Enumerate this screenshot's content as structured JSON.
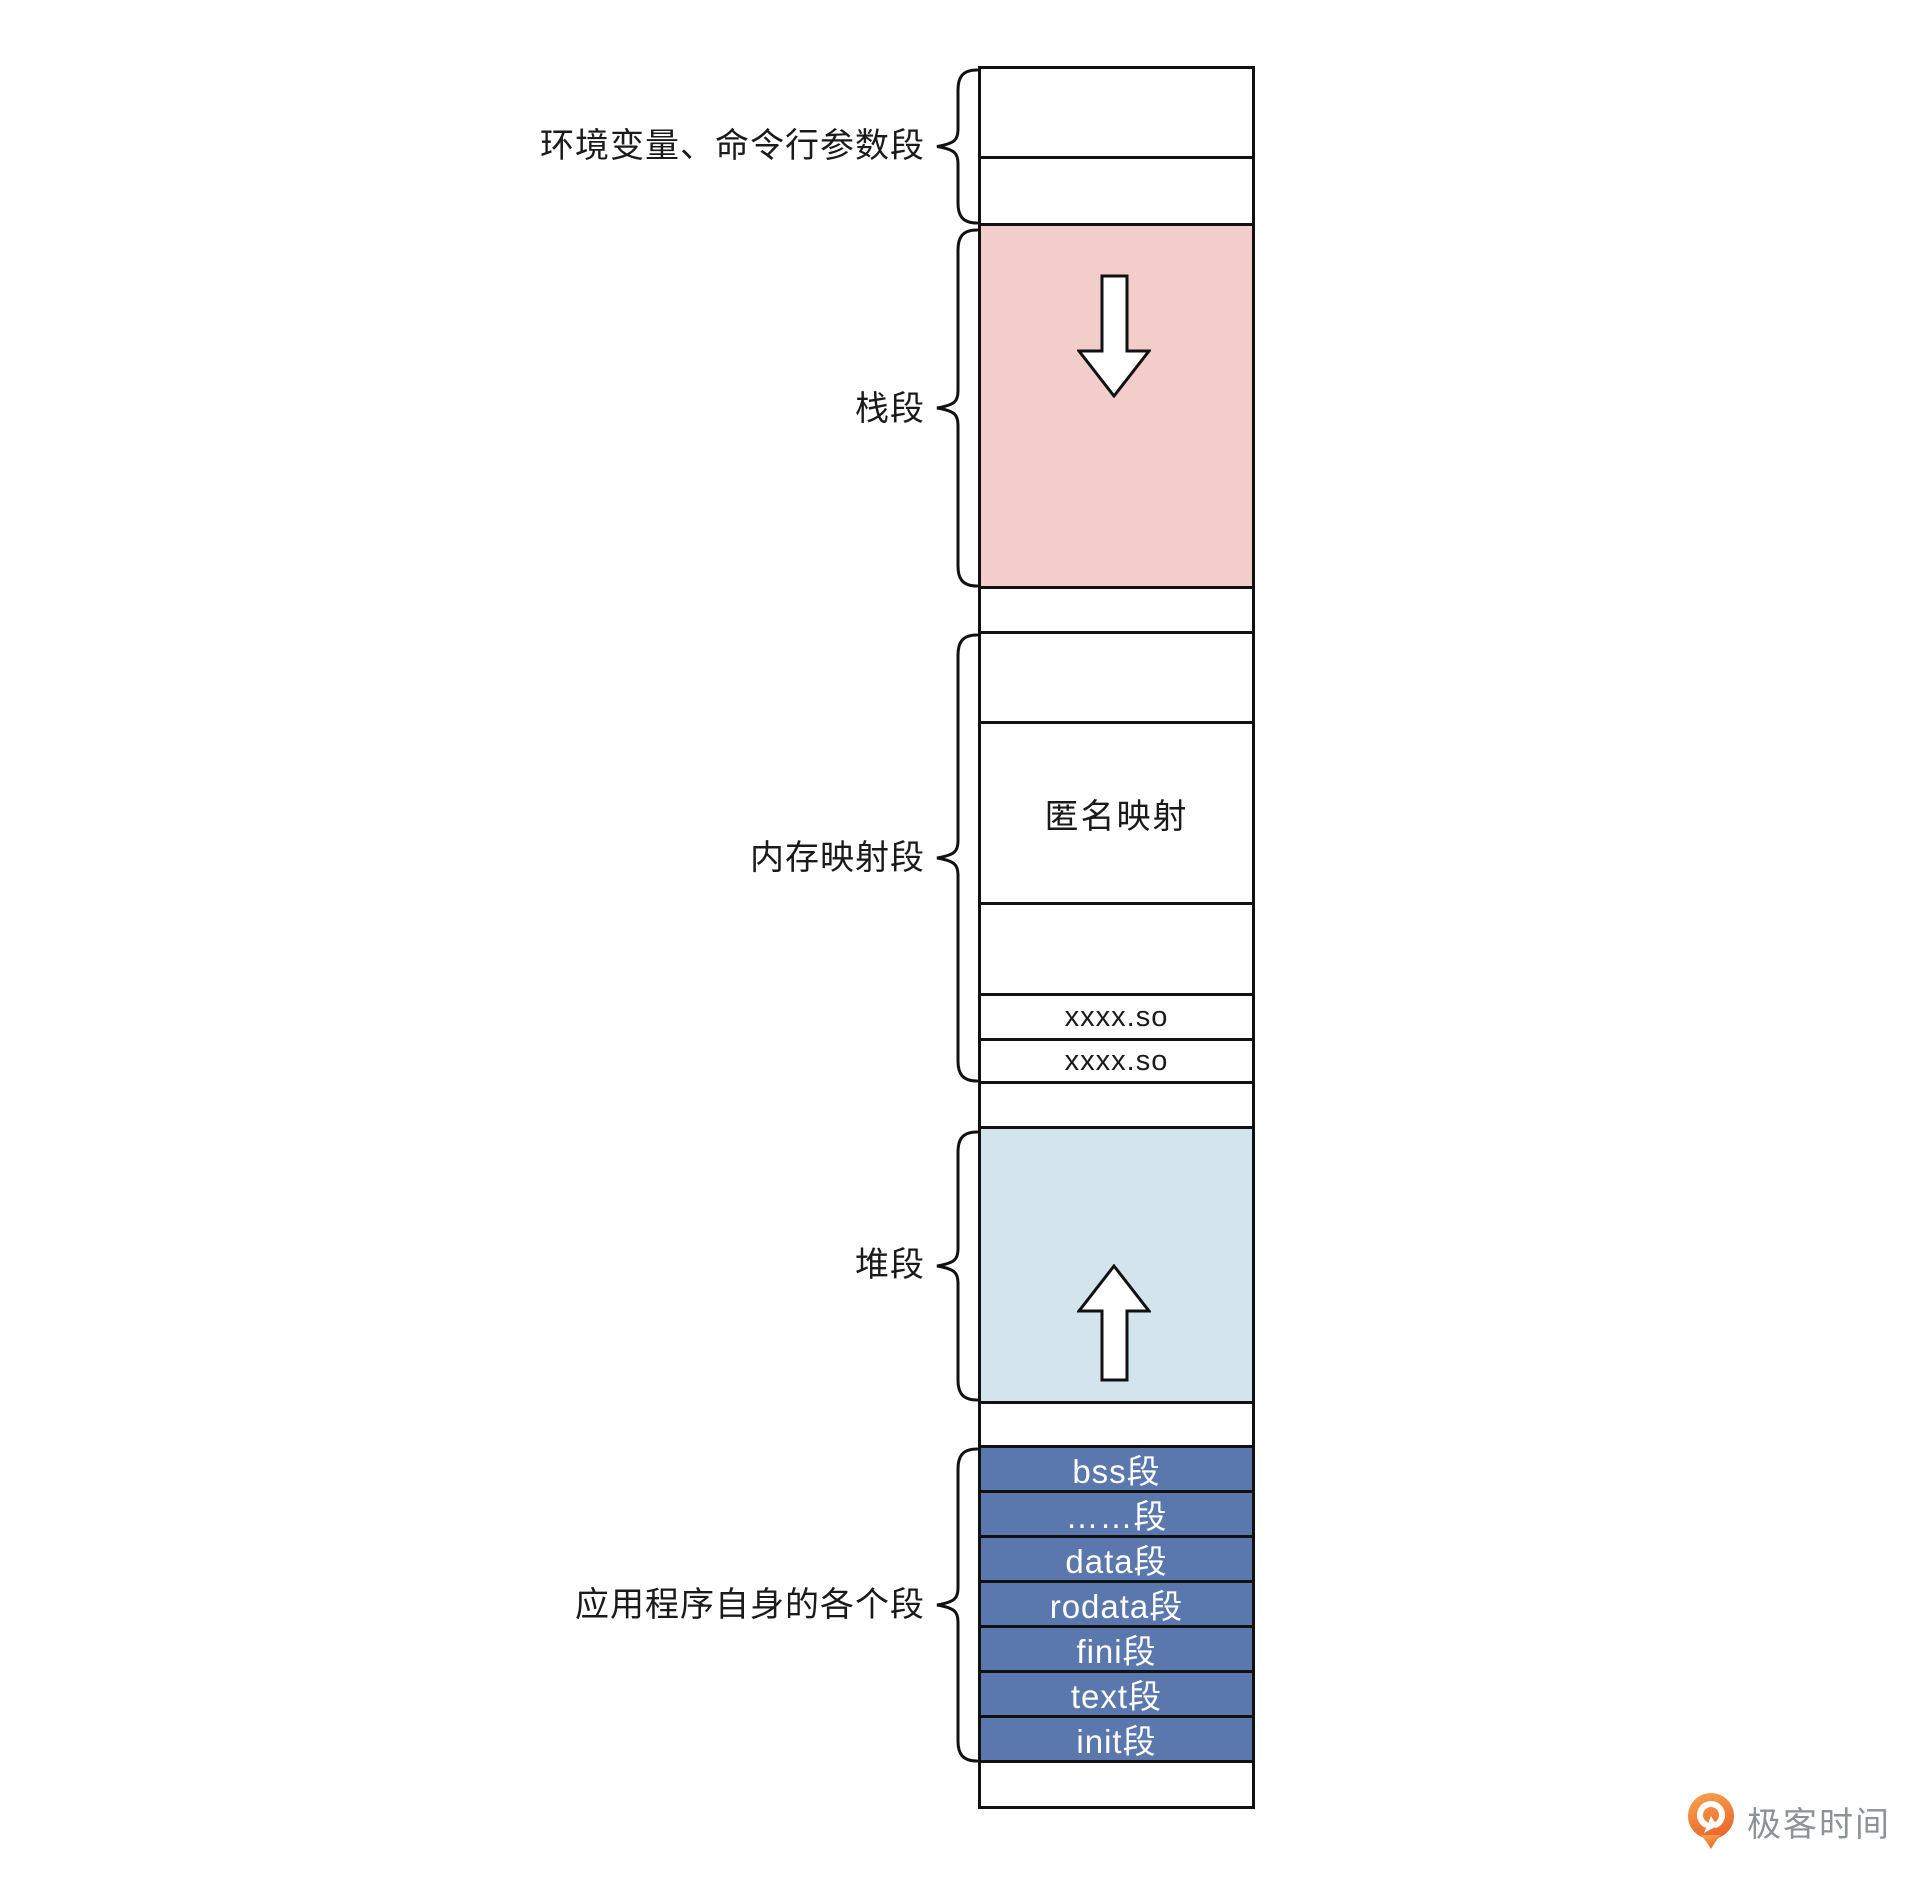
{
  "diagram": {
    "labels": {
      "env_args": "环境变量、命令行参数段",
      "stack": "栈段",
      "mmap": "内存映射段",
      "heap": "堆段",
      "app": "应用程序自身的各个段"
    },
    "cells": {
      "anonymous_mapping": "匿名映射",
      "so_top": "xxxx.so",
      "so_bottom": "xxxx.so"
    },
    "app_segments": [
      "bss段",
      "……段",
      "data段",
      "rodata段",
      "fini段",
      "text段",
      "init段"
    ],
    "icons": {
      "stack_growth": "down-arrow",
      "heap_growth": "up-arrow"
    },
    "colors": {
      "stack_fill": "#f3cdc9",
      "heap_fill": "#d4e4ed",
      "app_fill": "#5a78ad",
      "line": "#111111",
      "brand_orange_top": "#f9a14e",
      "brand_orange_bottom": "#e9662c",
      "brand_text_gray": "#8d9297"
    }
  },
  "footer": {
    "brand": "极客时间"
  }
}
